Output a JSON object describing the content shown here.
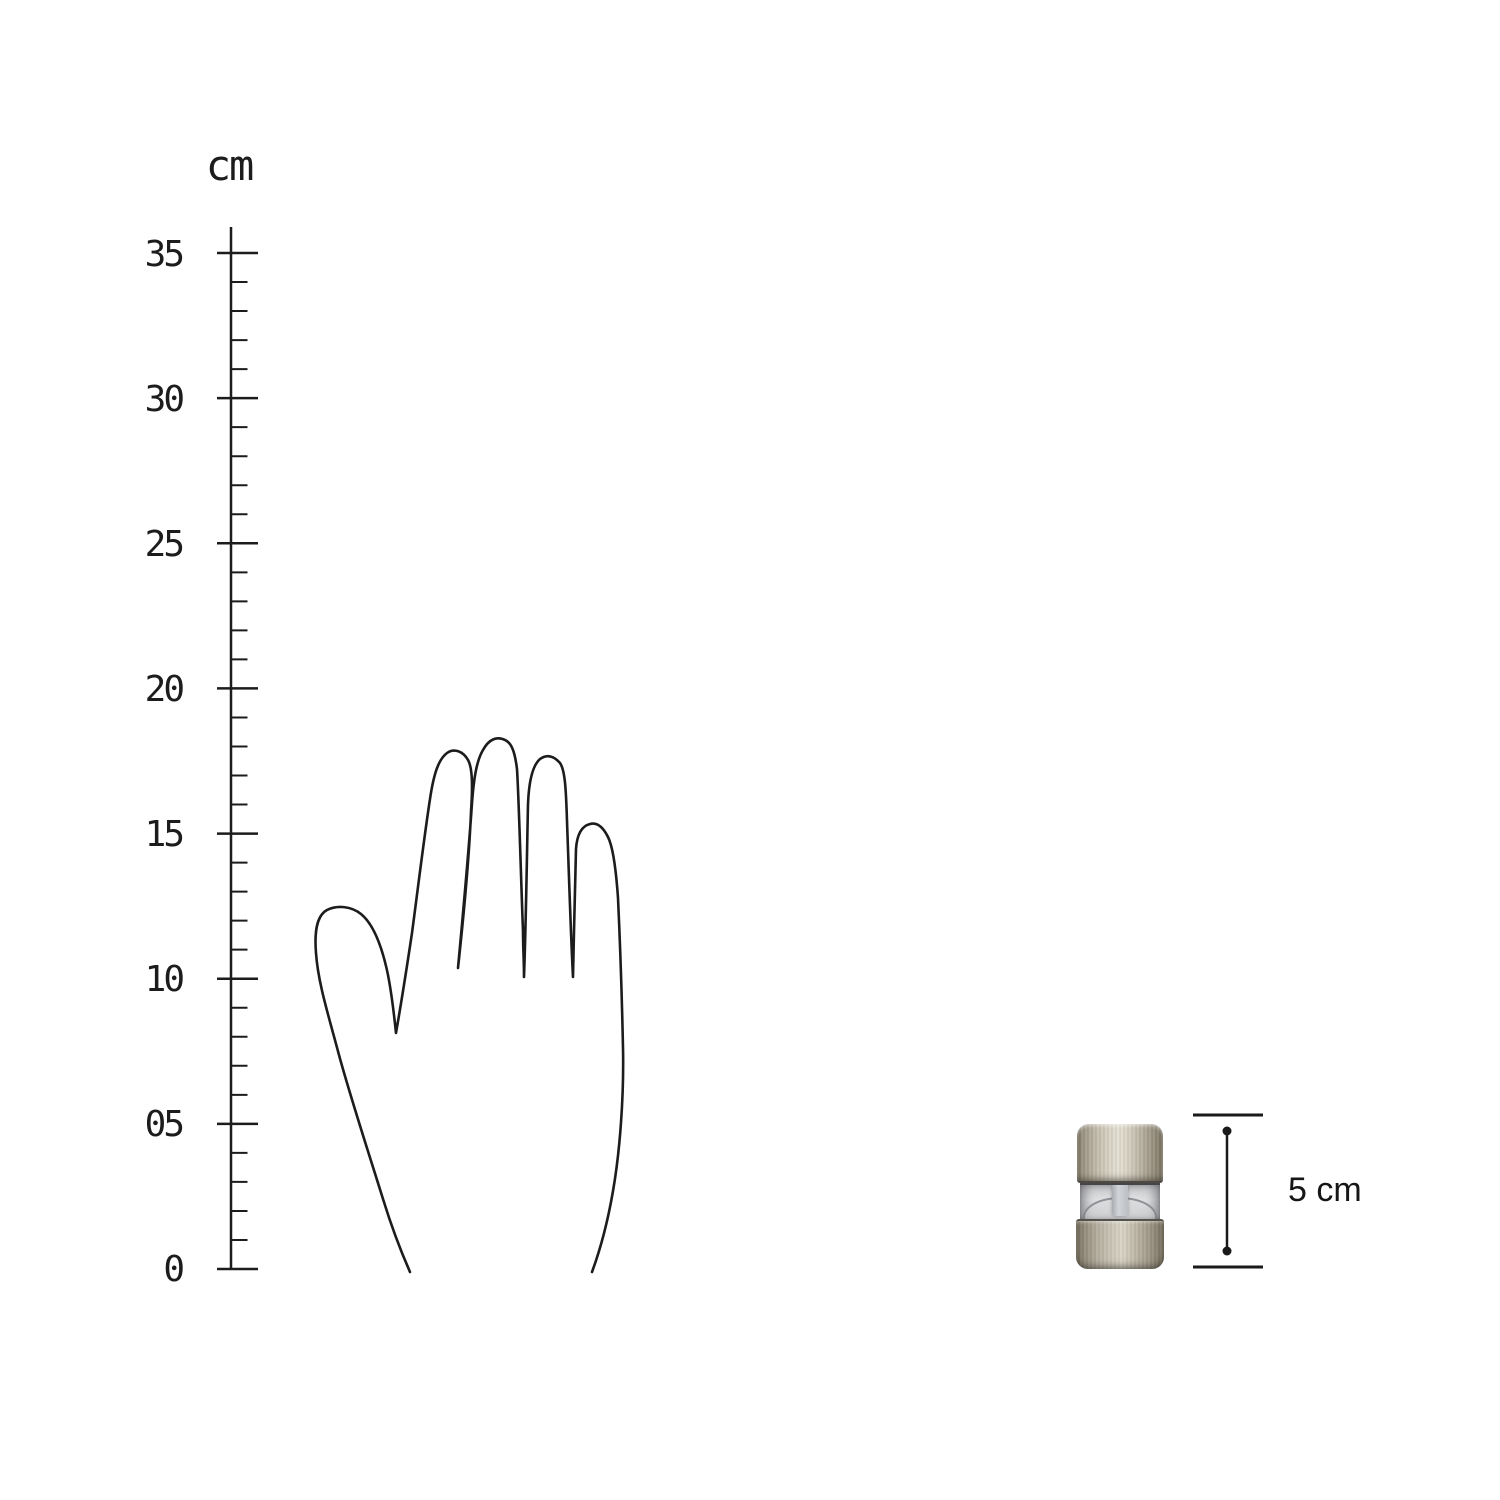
{
  "page": {
    "background_color": "#ffffff"
  },
  "ruler": {
    "unit_label": "cm",
    "min": 0,
    "max": 35,
    "major_step": 5,
    "minor_step": 1,
    "tick_labels": [
      "35",
      "30",
      "25",
      "20",
      "15",
      "10",
      "05",
      "0"
    ],
    "line_color": "#1c1c1c"
  },
  "hand_illustration": {
    "line_color": "#1c1c1c"
  },
  "product": {
    "semantic": "mini-spice-grinder-photo",
    "colors": {
      "metal_light": "#e3dfd2",
      "metal_dark": "#78715f",
      "acrylic_light": "#dfe0e2",
      "acrylic_shadow": "#76787c"
    }
  },
  "size_indicator": {
    "label": "5 cm",
    "line_color": "#1a1a1a"
  }
}
